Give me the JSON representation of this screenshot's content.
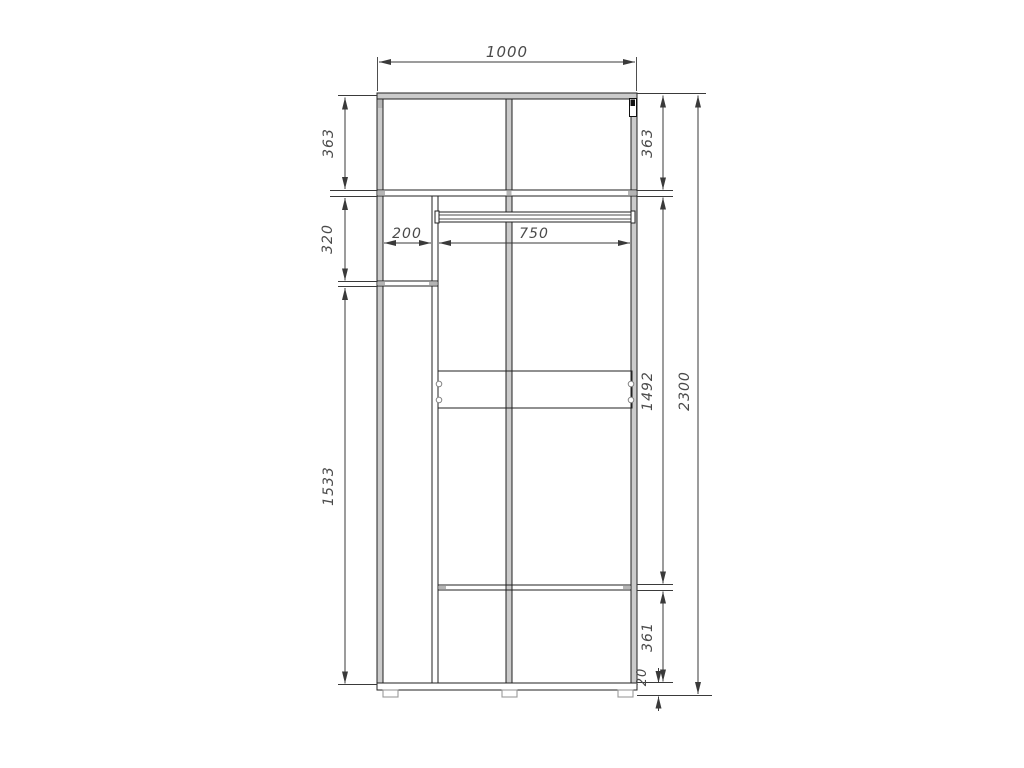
{
  "drawing": {
    "title": "wardrobe-section-technical-drawing",
    "dims": {
      "overall_width": "1000",
      "overall_height": "2300",
      "top_section_left": "363",
      "top_section_right": "363",
      "upper_left_section": "320",
      "left_column_height": "1533",
      "middle_section_right": "1492",
      "bottom_section_right": "361",
      "plinth_height": "20",
      "left_column_width": "200",
      "right_column_width": "750"
    },
    "colors": {
      "background": "#ffffff",
      "panel_fill": "#cbcbcb",
      "line": "#3a3a3a",
      "dim_text": "#4a4a4a"
    }
  }
}
